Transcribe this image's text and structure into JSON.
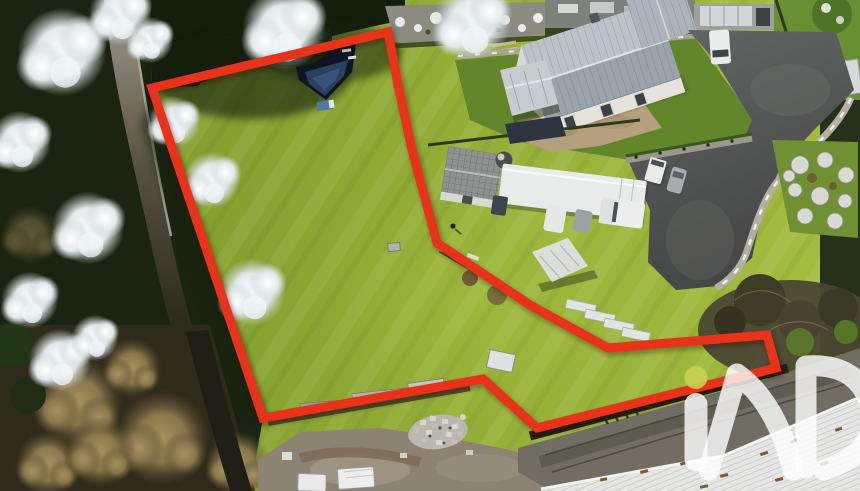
{
  "meta": {
    "kind": "aerial-drone-photograph",
    "subject": "real-estate land parcel outlined in red, adjoining house, driveways and wooded lane",
    "width_px": 860,
    "height_px": 491
  },
  "watermark": {
    "brand": "iad",
    "dot_color": "#c9d44e",
    "letter_color": "#ffffff",
    "opacity": 0.8,
    "position": "bottom-right, clipped by image edge"
  },
  "plot_boundary": {
    "color": "#e83219",
    "stroke_width_px": 9,
    "points": "388,32 398,85 412,150 437,243 530,305 608,348 767,335 776,368 537,428 483,379 263,418 152,88",
    "shape": "irregular closed polygon drawn over a grass meadow"
  },
  "scene": {
    "parcel": "mown yellow-green grass meadow with pond in upper-left corner",
    "pond": "dark-lined garden pond with blue water and small blue cart beside it",
    "left_edge": "narrow lane and stone wall flanked by snow-dusted conifers",
    "bottom_left": "bare brown deciduous trees",
    "house": "white house with grey standing-seam metal roof, side wing, annex roof and tan terrace",
    "right_side": "dark asphalt driveway with curved stone retaining wall and round white shrubs",
    "neighbour_yard": "shed, round tank, long white container, caravan, cars, pickup, stacked white panels",
    "bottom_center": "gravel yard with pile of pale rubble blocks and small white trailers",
    "bottom_right": "grey access road above a long white corrugated roof",
    "weather": "light snow dusting on trees and walls, low sun from the right"
  },
  "palette": {
    "grass_bright": "#a3bc40",
    "grass_mid": "#8faa36",
    "grass_shadow": "#5f8129",
    "forest_dark": "#1a2410",
    "snow": "#e9eef0",
    "asphalt": "#545654",
    "roof_grey": "#9aa3aa",
    "terrace_tan": "#b5a07e",
    "white_roof": "#e6e7e5",
    "gravel": "#8d8373"
  }
}
